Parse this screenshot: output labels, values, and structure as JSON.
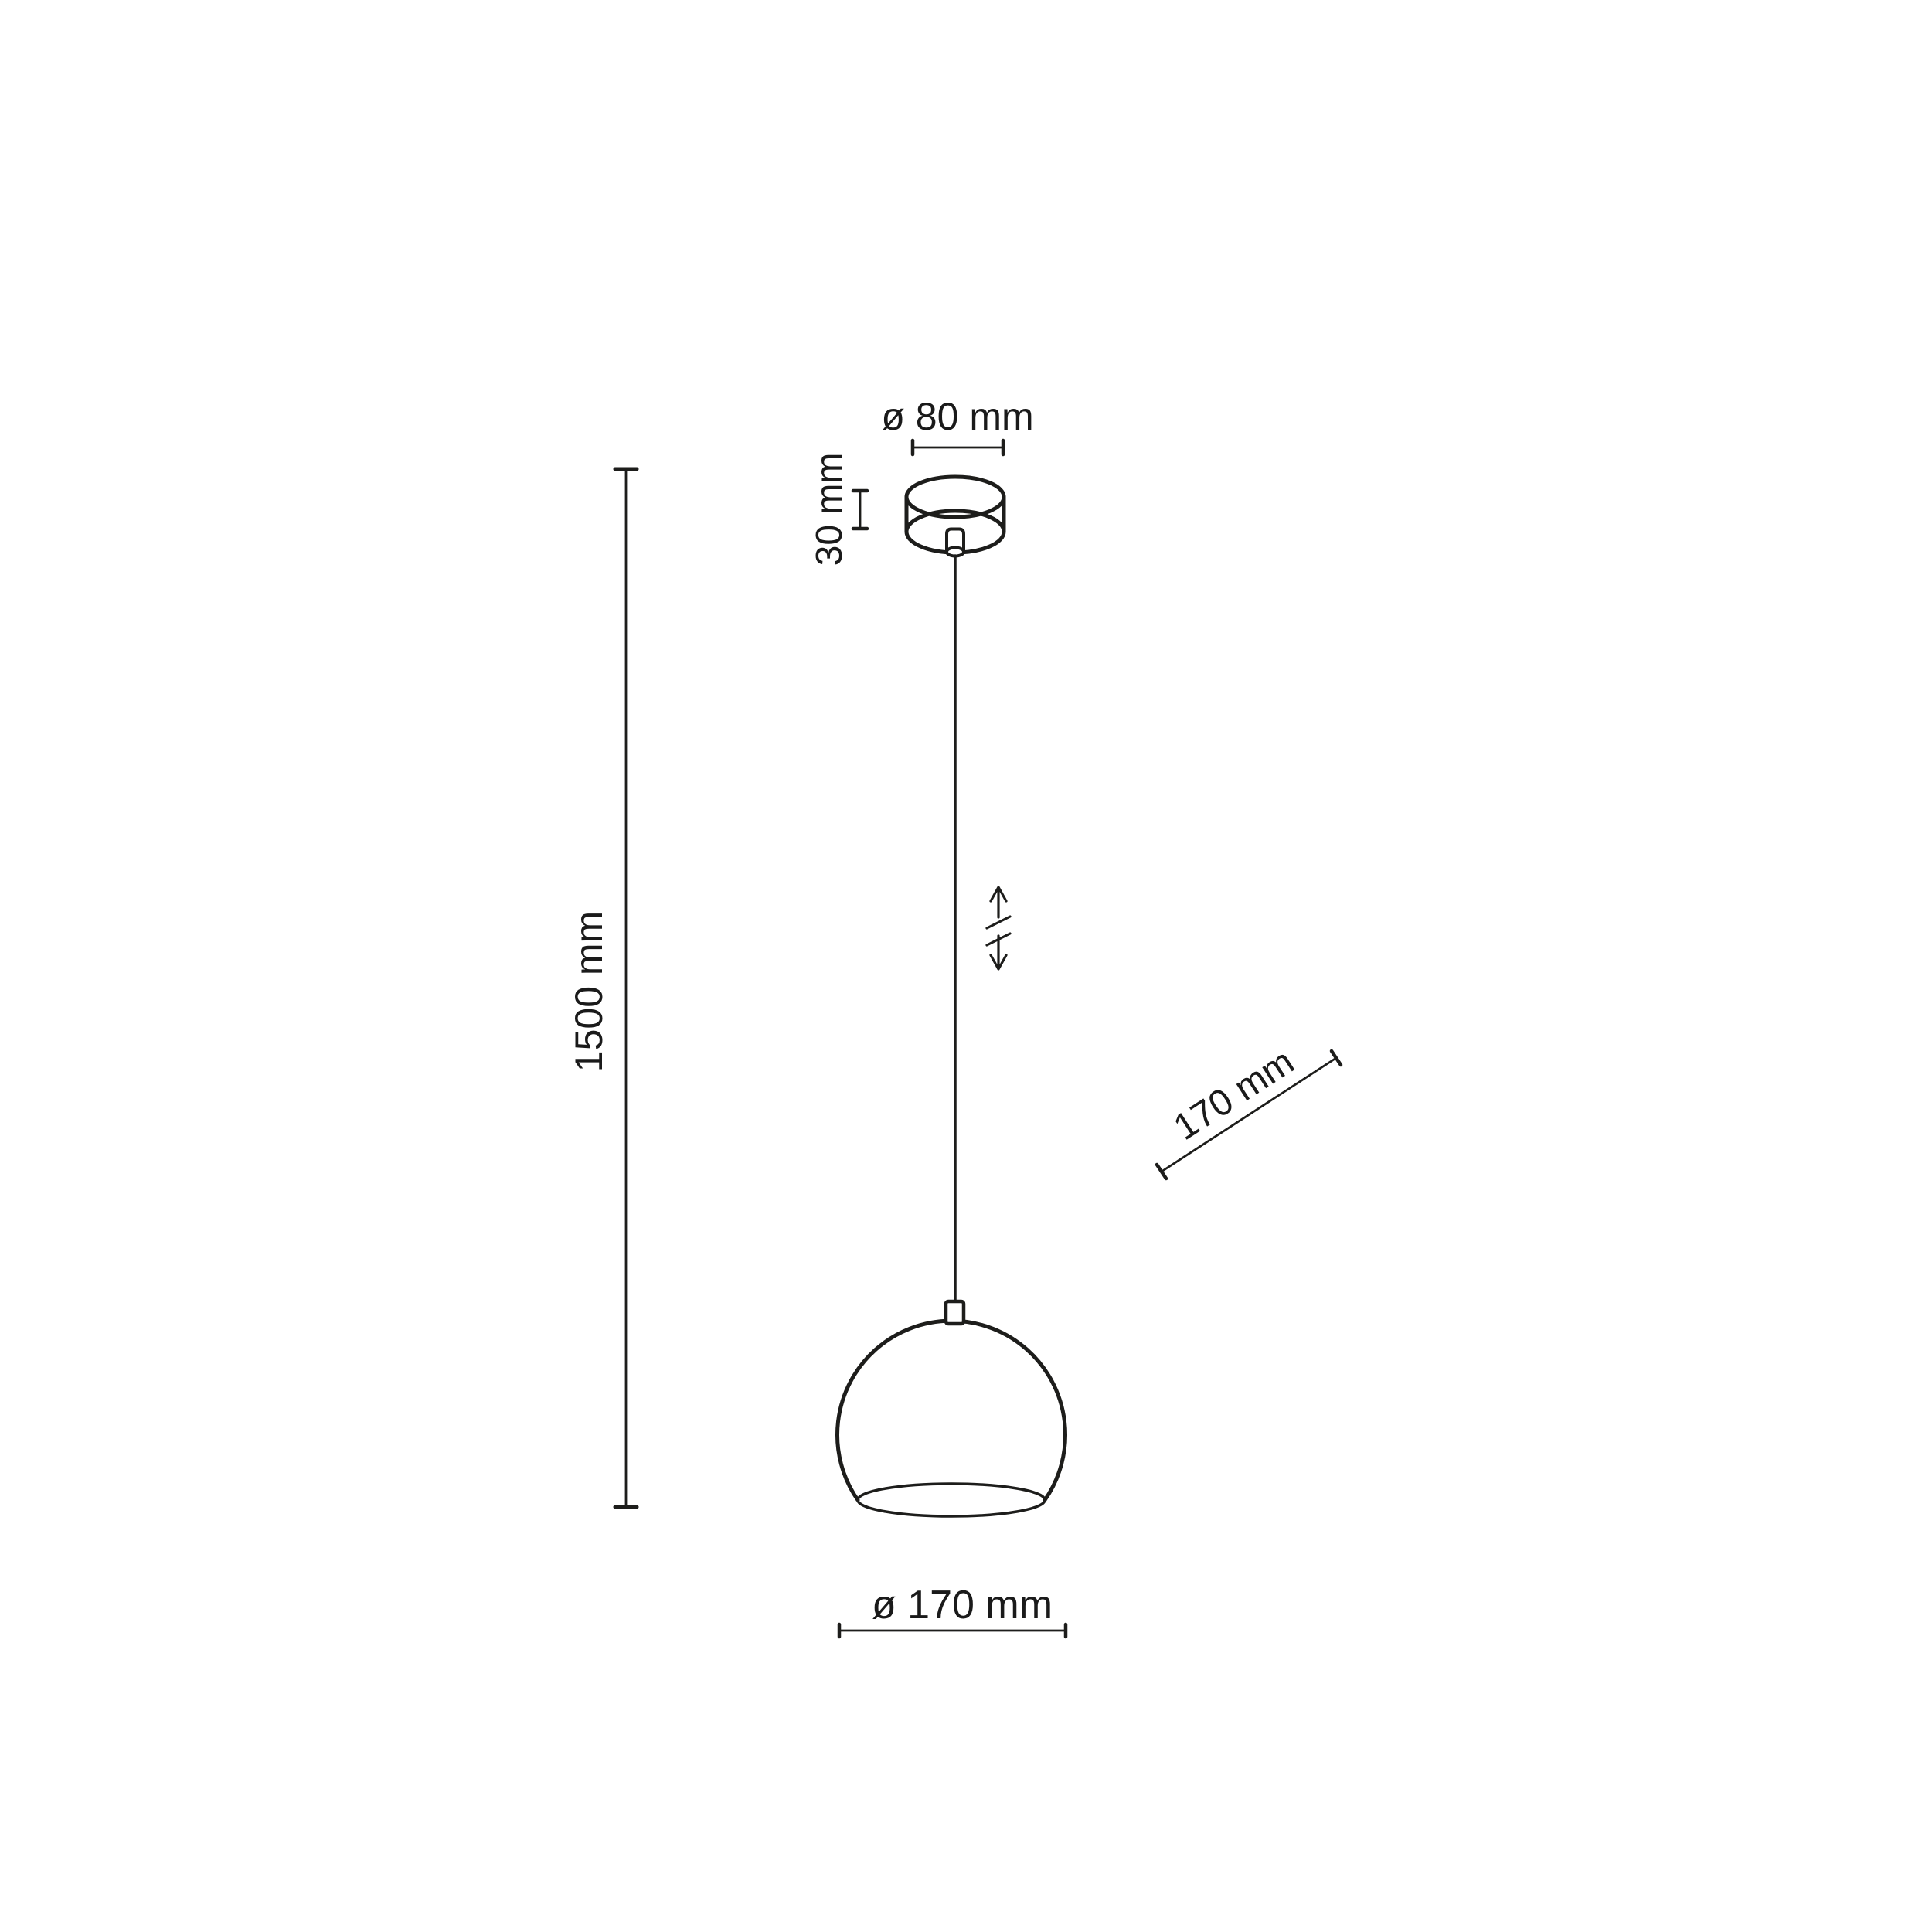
{
  "page": {
    "background_color": "#ffffff",
    "line_color": "#1d1d1b",
    "text_color": "#1a1a1a"
  },
  "diagram": {
    "labels": {
      "canopy_diameter": "ø 80 mm",
      "canopy_height": "30 mm",
      "suspension_height": "1500 mm",
      "shade_diagonal": "170 mm",
      "shade_diameter": "ø 170 mm"
    }
  }
}
